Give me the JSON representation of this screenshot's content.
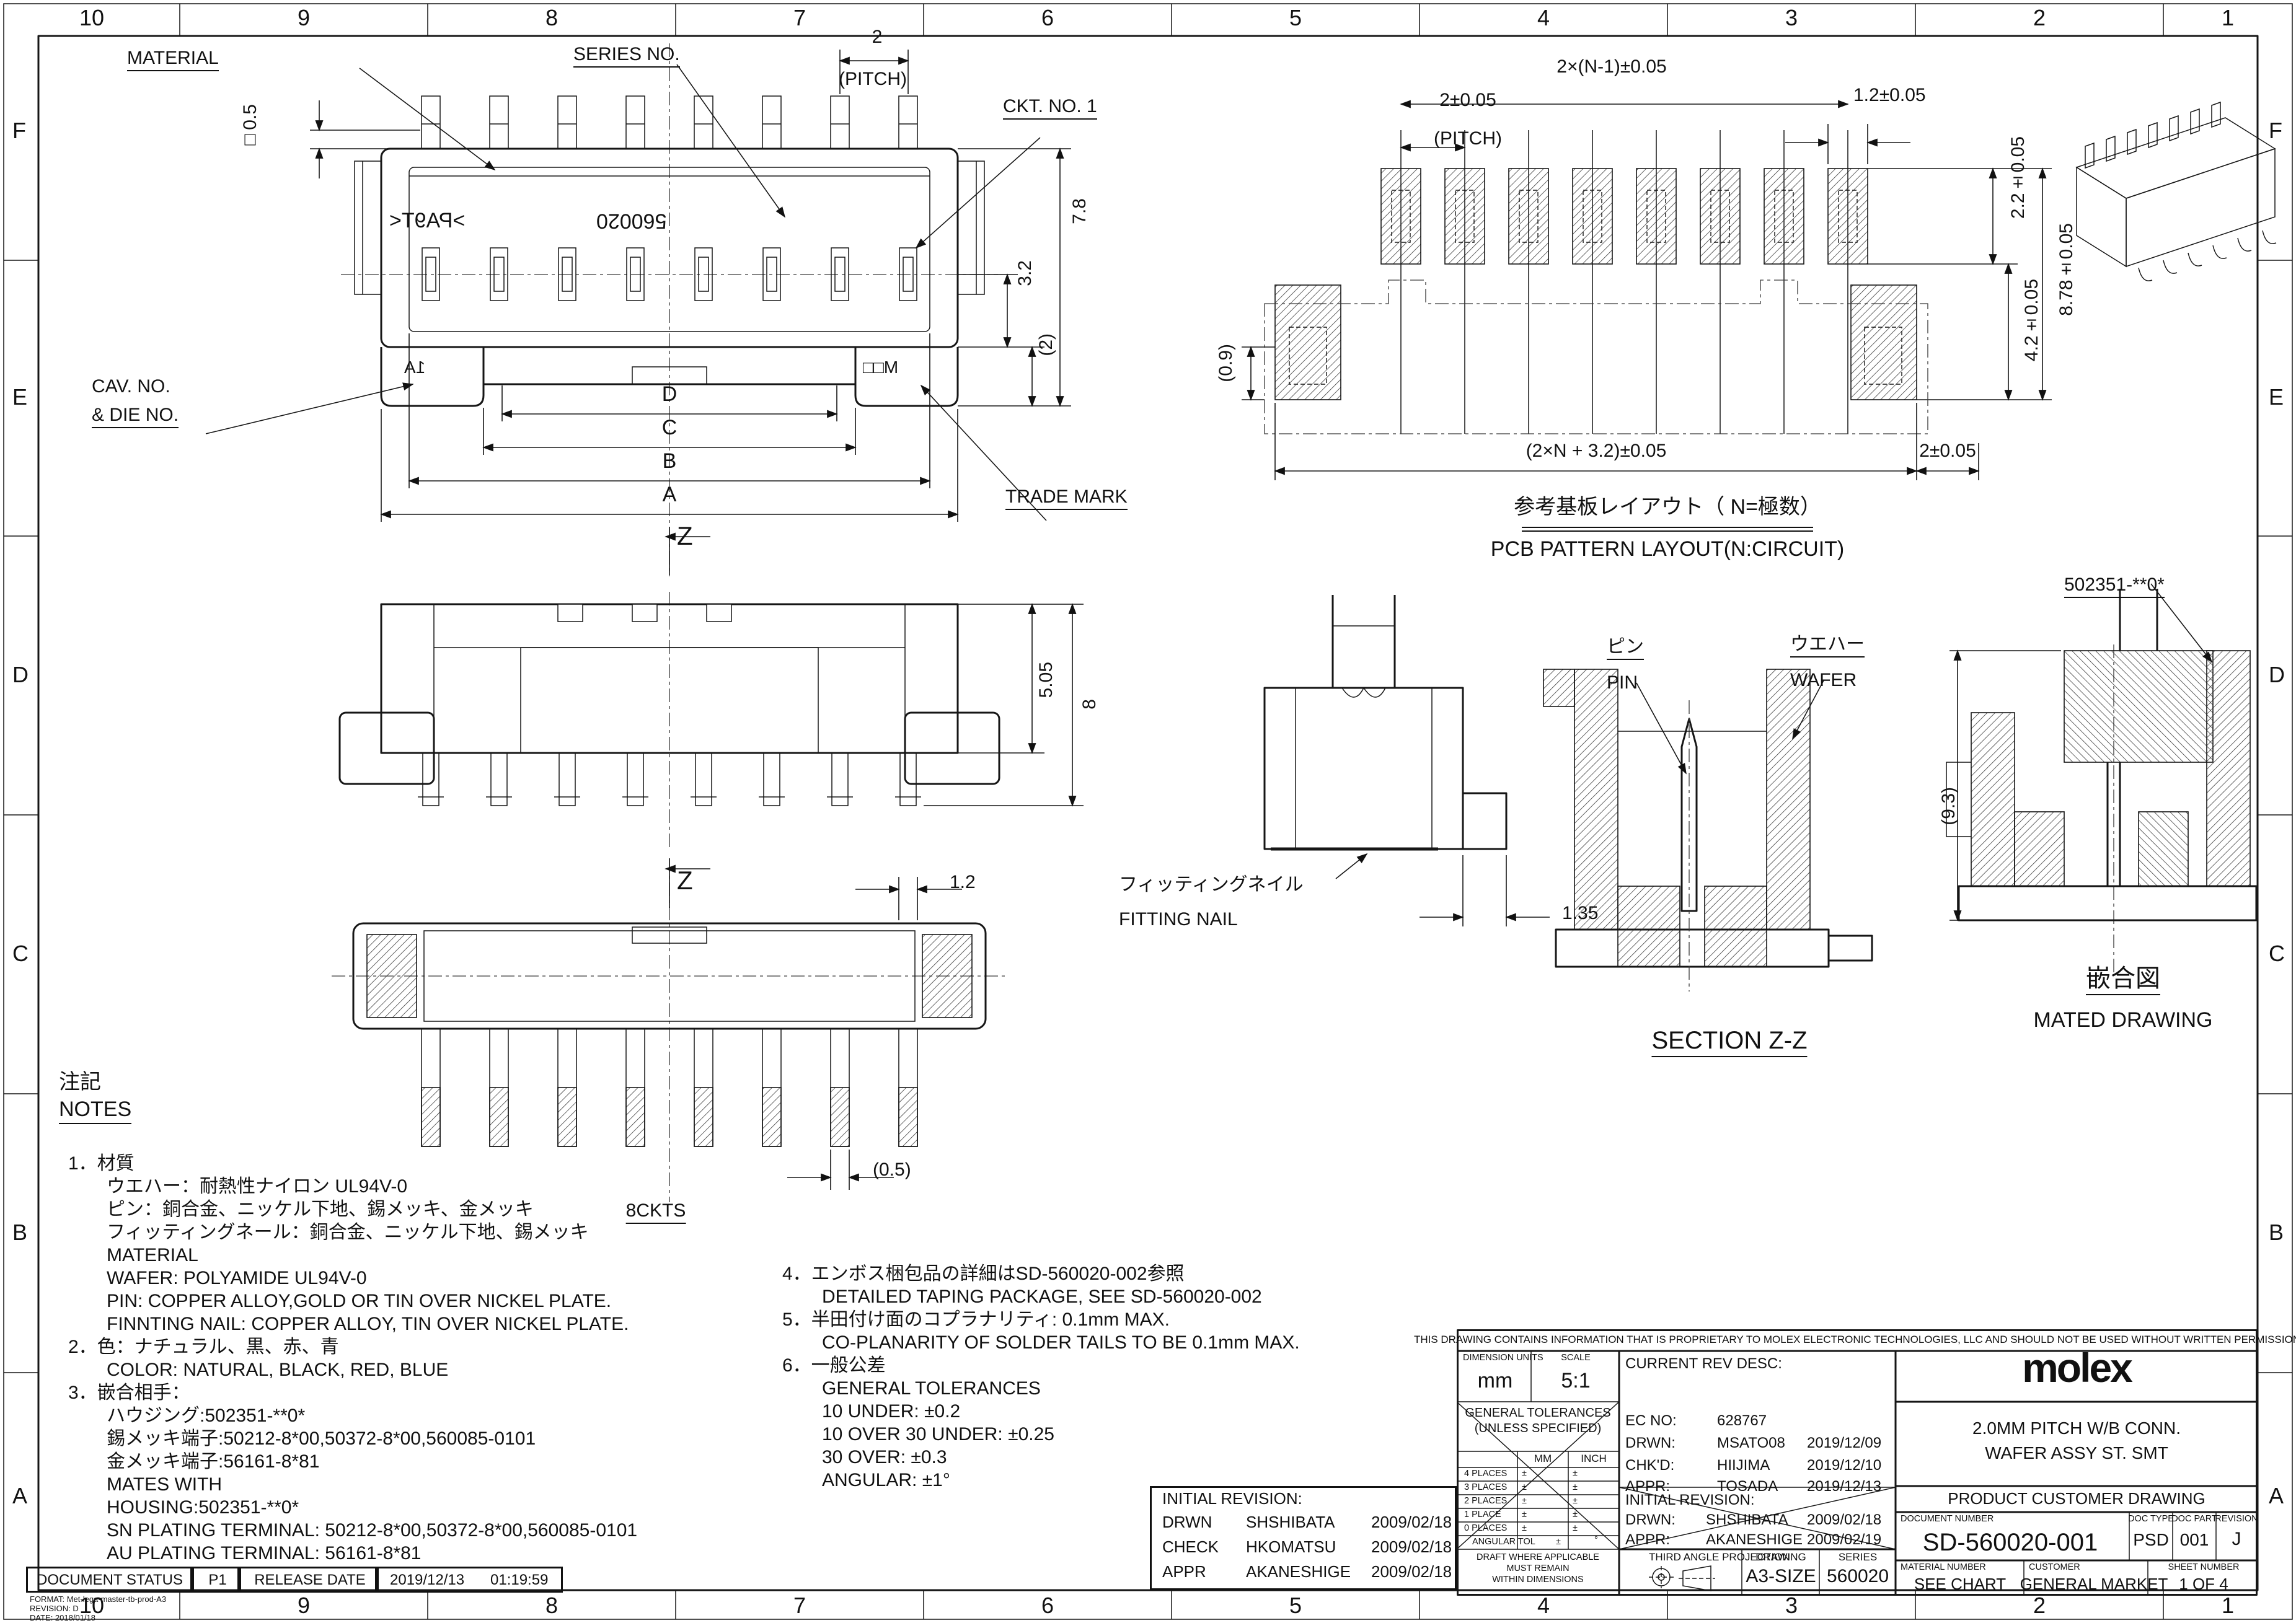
{
  "border": {
    "columns": [
      "10",
      "9",
      "8",
      "7",
      "6",
      "5",
      "4",
      "3",
      "2",
      "1"
    ],
    "rows": [
      "F",
      "E",
      "D",
      "C",
      "B",
      "A"
    ]
  },
  "front_view": {
    "material_label": "MATERIAL",
    "series_no_label": "SERIES NO.",
    "pitch_value": "2",
    "pitch_label": "(PITCH)",
    "ckt_no_label": "CKT. NO. 1",
    "sq_dim": "□0.5",
    "dim_3_2": "3.2",
    "dim_7_8": "7.8",
    "dim_2_paren": "(2)",
    "cav_no_label": "CAV. NO.",
    "die_no_label": "& DIE NO.",
    "trade_mark_label": "TRADE MARK",
    "dim_d": "D",
    "dim_c": "C",
    "dim_b": "B",
    "dim_a": "A",
    "section_z": "Z",
    "marking_material": ">PA9T<",
    "marking_series": "560020",
    "marking_cav": "1A",
    "marking_tm": "M□□"
  },
  "side_view": {
    "dim_5_05": "5.05",
    "dim_8": "8"
  },
  "bottom_view": {
    "dim_1_2": "1.2",
    "section_z": "Z",
    "dim_0_5": "(0.5)",
    "ckts_label": "8CKTS"
  },
  "pcb_layout": {
    "dim_span": "2×(N-1)±0.05",
    "dim_pitch": "2±0.05",
    "pitch_label": "(PITCH)",
    "dim_1_2": "1.2±0.05",
    "dim_2_2": "2.2±0.05",
    "dim_8_78": "8.78±0.05",
    "dim_4_2": "4.2±0.05",
    "dim_0_9": "(0.9)",
    "dim_total": "(2×N + 3.2)±0.05",
    "dim_2": "2±0.05",
    "title_jp": "参考基板レイアウト（ N=極数）",
    "title_en": "PCB PATTERN LAYOUT(N:CIRCUIT)"
  },
  "section_view": {
    "nail_jp": "フィッティングネイル",
    "nail_en": "FITTING NAIL",
    "dim_1_35": "1.35",
    "pin_jp": "ピン",
    "pin_en": "PIN",
    "wafer_jp": "ウエハー",
    "wafer_en": "WAFER",
    "title": "SECTION Z-Z"
  },
  "mated_view": {
    "part_no": "502351-**0*",
    "dim_9_3": "(9.3)",
    "title_jp": "嵌合図",
    "title_en": "MATED DRAWING"
  },
  "notes": {
    "header_jp": "注記",
    "header_en": "NOTES",
    "left": [
      "1．材質",
      "ウエハー：耐熱性ナイロン UL94V-0",
      "ピン：銅合金、ニッケル下地、錫メッキ、金メッキ",
      "フィッティングネール：銅合金、ニッケル下地、錫メッキ",
      "MATERIAL",
      "WAFER: POLYAMIDE UL94V-0",
      "PIN: COPPER ALLOY,GOLD OR TIN OVER NICKEL PLATE.",
      "FINNTING NAIL: COPPER ALLOY, TIN OVER NICKEL PLATE.",
      "2．色：ナチュラル、黒、赤、青",
      "COLOR: NATURAL, BLACK, RED, BLUE",
      "3．嵌合相手：",
      "ハウジング:502351-**0*",
      "錫メッキ端子:50212-8*00,50372-8*00,560085-0101",
      "金メッキ端子:56161-8*81",
      "MATES WITH",
      "HOUSING:502351-**0*",
      "SN PLATING TERMINAL: 50212-8*00,50372-8*00,560085-0101",
      "AU PLATING TERMINAL: 56161-8*81"
    ],
    "right": [
      "4．エンボス梱包品の詳細はSD-560020-002参照",
      "DETAILED TAPING PACKAGE, SEE SD-560020-002",
      "5．半田付け面のコプラナリティ: 0.1mm MAX.",
      "CO-PLANARITY OF SOLDER TAILS TO BE 0.1mm MAX.",
      "6．一般公差",
      "GENERAL TOLERANCES",
      "10 UNDER: ±0.2",
      "10 OVER 30 UNDER: ±0.25",
      "30 OVER: ±0.3",
      "ANGULAR: ±1°"
    ]
  },
  "revision_box": {
    "title": "INITIAL REVISION:",
    "rows": [
      {
        "role": "DRWN",
        "name": "SHSHIBATA",
        "date": "2009/02/18"
      },
      {
        "role": "CHECK",
        "name": "HKOMATSU",
        "date": "2009/02/18"
      },
      {
        "role": "APPR",
        "name": "AKANESHIGE",
        "date": "2009/02/18"
      }
    ]
  },
  "doc_status": {
    "label": "DOCUMENT STATUS",
    "value": "P1",
    "release_label": "RELEASE DATE",
    "date": "2019/12/13",
    "time": "01:19:59"
  },
  "format_info": {
    "line1": "FORMAT: Met-lega-master-tb-prod-A3",
    "line2": "REVISION: D",
    "line3": "DATE: 2018/01/18"
  },
  "title_block": {
    "proprietary": "THIS DRAWING CONTAINS INFORMATION THAT IS PROPRIETARY TO MOLEX ELECTRONIC TECHNOLOGIES, LLC AND SHOULD NOT BE USED WITHOUT WRITTEN PERMISSION",
    "dimension_units_label": "DIMENSION UNITS",
    "dimension_units": "mm",
    "scale_label": "SCALE",
    "scale": "5:1",
    "general_tolerances": "GENERAL TOLERANCES",
    "unless_specified": "(UNLESS SPECIFIED)",
    "col_mm": "MM",
    "col_inch": "INCH",
    "tol_row_0": "4 PLACES",
    "tol_row_1": "3 PLACES",
    "tol_row_2": "2 PLACES",
    "tol_row_3": "1 PLACE",
    "tol_row_4": "0 PLACES",
    "angular_tol_label": "ANGULAR TOL",
    "pm": "±",
    "deg": "°",
    "draft_note_1": "DRAFT WHERE APPLICABLE",
    "draft_note_2": "MUST REMAIN",
    "draft_note_3": "WITHIN DIMENSIONS",
    "current_rev_label": "CURRENT REV DESC:",
    "ec_no_label": "EC NO:",
    "ec_no": "628767",
    "drwn_label": "DRWN:",
    "drwn": "MSATO08",
    "drwn_date": "2019/12/09",
    "chkd_label": "CHK'D:",
    "chkd": "HIIJIMA",
    "chkd_date": "2019/12/10",
    "appr_label": "APPR:",
    "appr": "TOSADA",
    "appr_date": "2019/12/13",
    "initial_rev_label": "INITIAL REVISION:",
    "init_drwn_label": "DRWN:",
    "init_drwn": "SHSHIBATA",
    "init_drwn_date": "2009/02/18",
    "init_appr_label": "APPR:",
    "init_appr": "AKANESHIGE",
    "init_appr_date": "2009/02/19",
    "third_angle_label": "THIRD ANGLE PROJECTION",
    "drawing_label": "DRAWING",
    "drawing_size": "A3-SIZE",
    "series_label": "SERIES",
    "series": "560020",
    "brand": "molex",
    "title_line1": "2.0MM PITCH W/B CONN.",
    "title_line2": "WAFER ASSY ST. SMT",
    "product_customer_drawing": "PRODUCT CUSTOMER DRAWING",
    "document_number_label": "DOCUMENT NUMBER",
    "document_number": "SD-560020-001",
    "doc_type_label": "DOC TYPE",
    "doc_type": "PSD",
    "doc_part_label": "DOC PART",
    "doc_part": "001",
    "revision_label": "REVISION",
    "revision": "J",
    "material_number_label": "MATERIAL NUMBER",
    "material_number": "SEE CHART",
    "customer_label": "CUSTOMER",
    "customer": "GENERAL MARKET",
    "sheet_number_label": "SHEET NUMBER",
    "sheet_number": "1 OF 4"
  }
}
